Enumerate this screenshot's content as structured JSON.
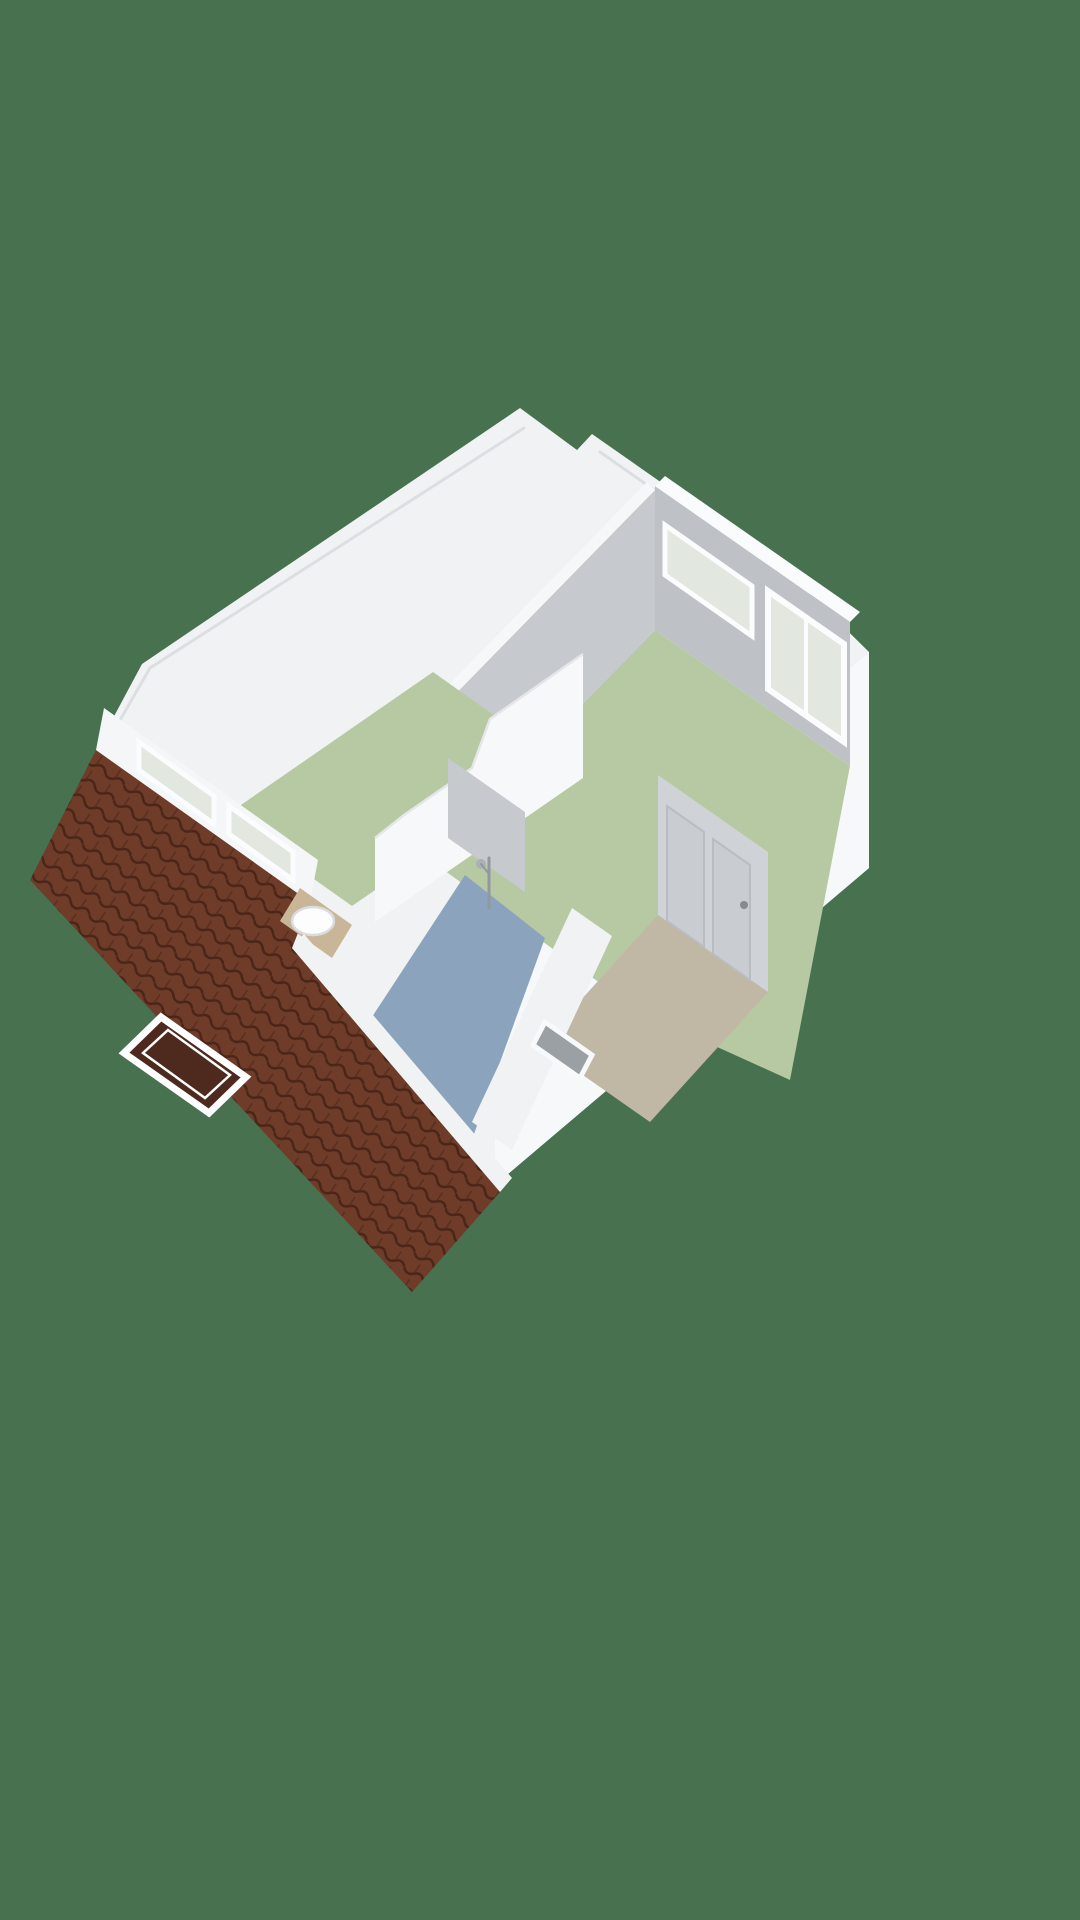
{
  "scene": {
    "type": "3d-floorplan-isometric-render",
    "floor_shown": "attic-storey-with-pitched-roof",
    "text_labels": [],
    "rooms": [
      {
        "id": "bedroom-large",
        "floor": "green"
      },
      {
        "id": "bedroom-small",
        "floor": "green"
      },
      {
        "id": "bathroom",
        "floor": "blue"
      },
      {
        "id": "hallway-landing",
        "floor": "beige"
      }
    ],
    "fixtures": [
      "washbasin",
      "shower",
      "closet-doors",
      "stair-opening-slot"
    ],
    "windows": [
      "ne-band-window",
      "ne-lower-window",
      "knee-wall-window-1",
      "knee-wall-window-2",
      "roof-skylight"
    ]
  },
  "colors": {
    "background": "#47714F",
    "wall_white": "#F1F2F4",
    "wall_bright": "#F7F8FA",
    "wall_band": "#FAFBFC",
    "wall_band_soft": "#F6F7F9",
    "wall_gray_face": "#BEC2C7",
    "wall_gray_face2": "#C6C9CE",
    "closet_wall_gray": "#CFD2D6",
    "closet_panel_gray": "#C9CCD0",
    "door_handle_gray": "#878B90",
    "floor_green": "#B7C9A3",
    "floor_blue": "#8BA3BD",
    "floor_beige": "#C1B7A5",
    "roof_tile_brown": "#6F3C2A",
    "roof_tile_line": "#4A2518",
    "skylight_glass": "#4E2A1E",
    "window_glass": "#E2E7DF",
    "window_frame": "#FBFCFD",
    "counter_tan": "#C9B698",
    "basin_white": "#FDFDFE",
    "slot_gray": "#9BA0A5",
    "knee_band_white": "#F5F6F8",
    "fixture_chrome": "#ABB0B6"
  }
}
